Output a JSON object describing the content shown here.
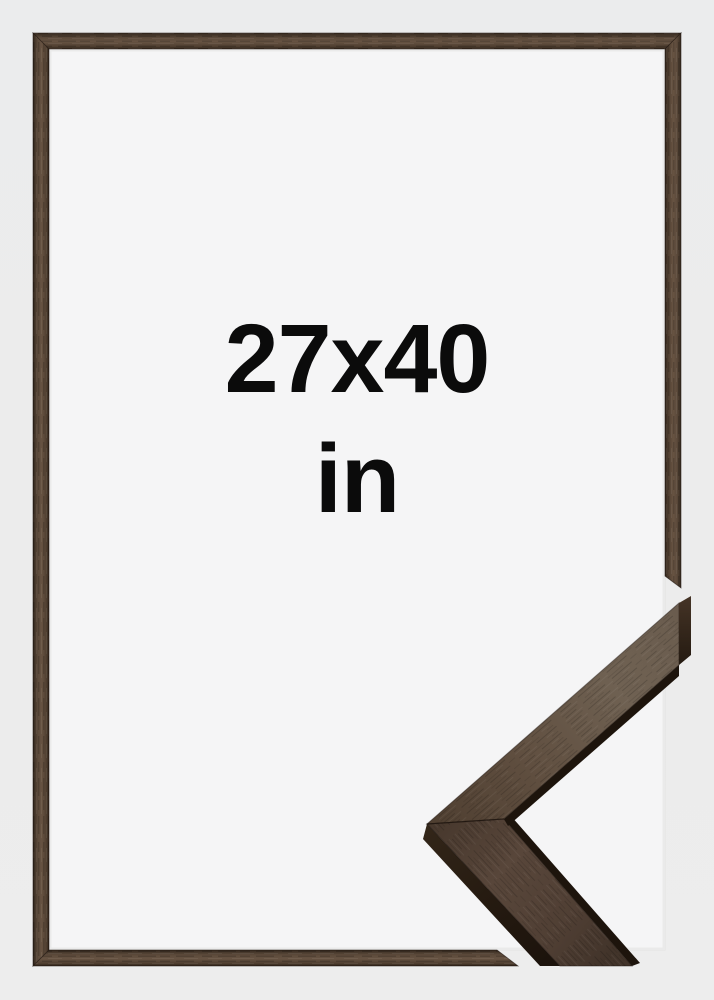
{
  "product_image": {
    "size_label": "27x40",
    "unit_label": "in",
    "colors": {
      "background": "#ebeced",
      "frame_opening": "#f5f5f6",
      "frame_wood_mid": "#5e4b3c",
      "frame_wood_edge": "#30251b",
      "corner_detail_face_light": "#6f6152",
      "corner_detail_face_dark": "#4a3a2f",
      "corner_detail_side_dark": "#241a11",
      "label_text": "#0b0b0b"
    }
  }
}
